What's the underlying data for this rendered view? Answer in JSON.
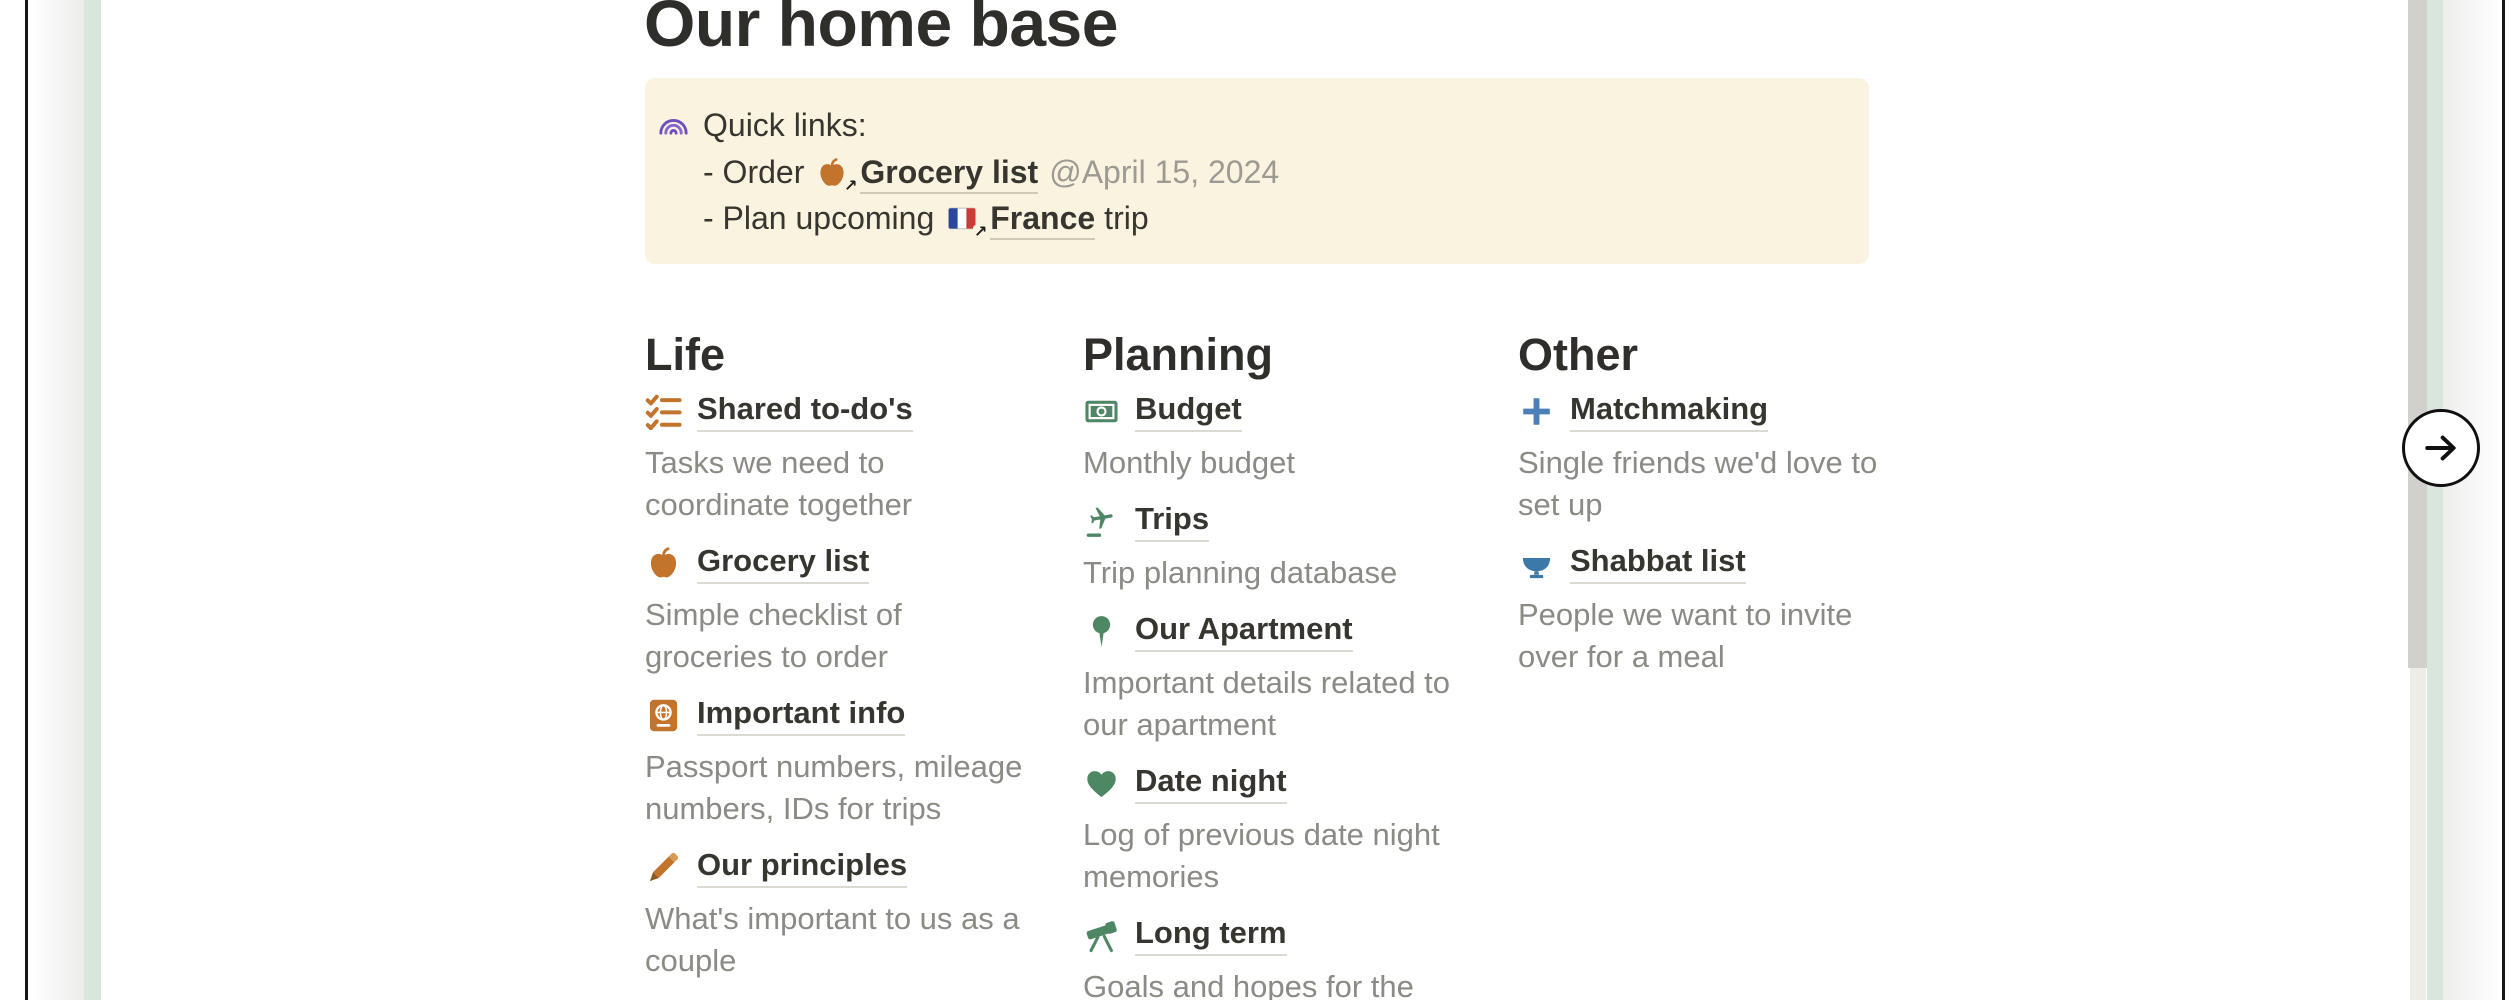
{
  "page": {
    "title": "Our home base",
    "callout": {
      "icon": "rainbow-icon",
      "heading": "Quick links:",
      "links": [
        {
          "prefix": "- Order",
          "icon": "apple-icon",
          "link_text": "Grocery list",
          "date_mention": "@April 15, 2024",
          "link_arrow_glyph": "↗"
        },
        {
          "prefix": "- Plan upcoming",
          "icon": "france-flag-icon",
          "link_text": "France",
          "suffix": "trip",
          "link_arrow_glyph": "↗"
        }
      ]
    },
    "columns": [
      {
        "heading": "Life",
        "items": [
          {
            "icon": "checklist-icon",
            "title": "Shared to-do's",
            "description": "Tasks we need to\ncoordinate together"
          },
          {
            "icon": "apple-icon",
            "title": "Grocery list",
            "description": "Simple checklist of\ngroceries to order"
          },
          {
            "icon": "passport-icon",
            "title": "Important info",
            "description": "Passport numbers, mileage\nnumbers, IDs for trips"
          },
          {
            "icon": "pencil-icon",
            "title": "Our principles",
            "description": "What's important to us as a\ncouple"
          }
        ]
      },
      {
        "heading": "Planning",
        "items": [
          {
            "icon": "banknote-icon",
            "title": "Budget",
            "description": "Monthly budget"
          },
          {
            "icon": "airplane-icon",
            "title": "Trips",
            "description": "Trip planning database"
          },
          {
            "icon": "pushpin-icon",
            "title": "Our Apartment",
            "description": "Important details related to\nour apartment"
          },
          {
            "icon": "heart-icon",
            "title": "Date night",
            "description": "Log of previous date night\nmemories"
          },
          {
            "icon": "telescope-icon",
            "title": "Long term",
            "description": "Goals and hopes for the"
          }
        ]
      },
      {
        "heading": "Other",
        "items": [
          {
            "icon": "plus-icon",
            "title": "Matchmaking",
            "description": "Single friends we'd love to\nset up"
          },
          {
            "icon": "bowl-icon",
            "title": "Shabbat list",
            "description": "People we want to invite\nover for a meal"
          }
        ]
      }
    ]
  },
  "carousel": {
    "next_button_icon": "arrow-right-icon"
  },
  "colors": {
    "accent_orange": "#C2742C",
    "accent_green": "#4E8764",
    "accent_blue": "#4A80B6",
    "accent_purple": "#6F4DBF",
    "callout_bg": "#FAF3DF",
    "link_underline": "#DBD9D2",
    "description_gray": "#8C8A84",
    "text_dark": "#37352F",
    "side_card_green": "#D8E7DC"
  }
}
